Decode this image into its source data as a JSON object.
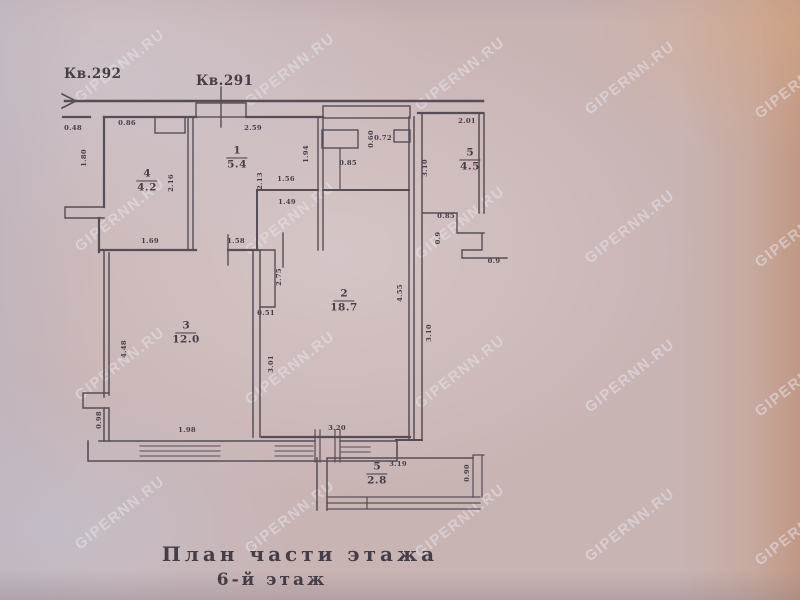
{
  "watermark": {
    "text": "GIPERNN.RU"
  },
  "captions": {
    "apartment_left": "Кв.292",
    "apartment_right": "Кв.291",
    "title": "План части этажа",
    "floor": "6-й этаж"
  },
  "rooms": [
    {
      "number": "1",
      "area": "5.4",
      "x": 237,
      "y": 158
    },
    {
      "number": "4",
      "area": "4.2",
      "x": 147,
      "y": 181
    },
    {
      "number": "5",
      "area": "4.5",
      "x": 470,
      "y": 160
    },
    {
      "number": "2",
      "area": "18.7",
      "x": 344,
      "y": 301
    },
    {
      "number": "3",
      "area": "12.0",
      "x": 186,
      "y": 333
    },
    {
      "number": "5",
      "area": "2.8",
      "x": 377,
      "y": 474
    }
  ],
  "dimensions": [
    {
      "t": "0.48",
      "x": 73,
      "y": 128,
      "r": 0
    },
    {
      "t": "0.86",
      "x": 127,
      "y": 123,
      "r": 0
    },
    {
      "t": "2.59",
      "x": 253,
      "y": 128,
      "r": 0
    },
    {
      "t": "1.94",
      "x": 306,
      "y": 154,
      "r": -90
    },
    {
      "t": "2.01",
      "x": 467,
      "y": 121,
      "r": 0
    },
    {
      "t": "0.72",
      "x": 383,
      "y": 138,
      "r": 0
    },
    {
      "t": "0.60",
      "x": 371,
      "y": 139,
      "r": -90
    },
    {
      "t": "0.85",
      "x": 348,
      "y": 163,
      "r": 0
    },
    {
      "t": "1.56",
      "x": 286,
      "y": 179,
      "r": 0
    },
    {
      "t": "1.49",
      "x": 287,
      "y": 202,
      "r": 0
    },
    {
      "t": "2.16",
      "x": 171,
      "y": 183,
      "r": -90
    },
    {
      "t": "2.13",
      "x": 260,
      "y": 181,
      "r": -90
    },
    {
      "t": "1.80",
      "x": 84,
      "y": 158,
      "r": -90
    },
    {
      "t": "1.69",
      "x": 150,
      "y": 241,
      "r": 0
    },
    {
      "t": "1.58",
      "x": 236,
      "y": 241,
      "r": 0
    },
    {
      "t": "2.75",
      "x": 279,
      "y": 277,
      "r": -90
    },
    {
      "t": "0.51",
      "x": 266,
      "y": 313,
      "r": 0
    },
    {
      "t": "4.48",
      "x": 124,
      "y": 349,
      "r": -90
    },
    {
      "t": "3.01",
      "x": 271,
      "y": 364,
      "r": -90
    },
    {
      "t": "1.98",
      "x": 187,
      "y": 430,
      "r": 0
    },
    {
      "t": "3.20",
      "x": 337,
      "y": 428,
      "r": 0
    },
    {
      "t": "4.55",
      "x": 400,
      "y": 293,
      "r": -90
    },
    {
      "t": "3.10",
      "x": 429,
      "y": 333,
      "r": -90
    },
    {
      "t": "3.10",
      "x": 425,
      "y": 168,
      "r": -90
    },
    {
      "t": "0.98",
      "x": 99,
      "y": 420,
      "r": -90
    },
    {
      "t": "0.85",
      "x": 446,
      "y": 216,
      "r": 0
    },
    {
      "t": "0.9",
      "x": 438,
      "y": 238,
      "r": -90
    },
    {
      "t": "0.9",
      "x": 494,
      "y": 261,
      "r": 0
    },
    {
      "t": "3.19",
      "x": 398,
      "y": 464,
      "r": 0
    },
    {
      "t": "0.90",
      "x": 467,
      "y": 473,
      "r": -90
    }
  ],
  "colors": {
    "paper": "#c9b4b4",
    "ink": "#453d48",
    "watermark": "rgba(230,226,233,0.55)"
  }
}
